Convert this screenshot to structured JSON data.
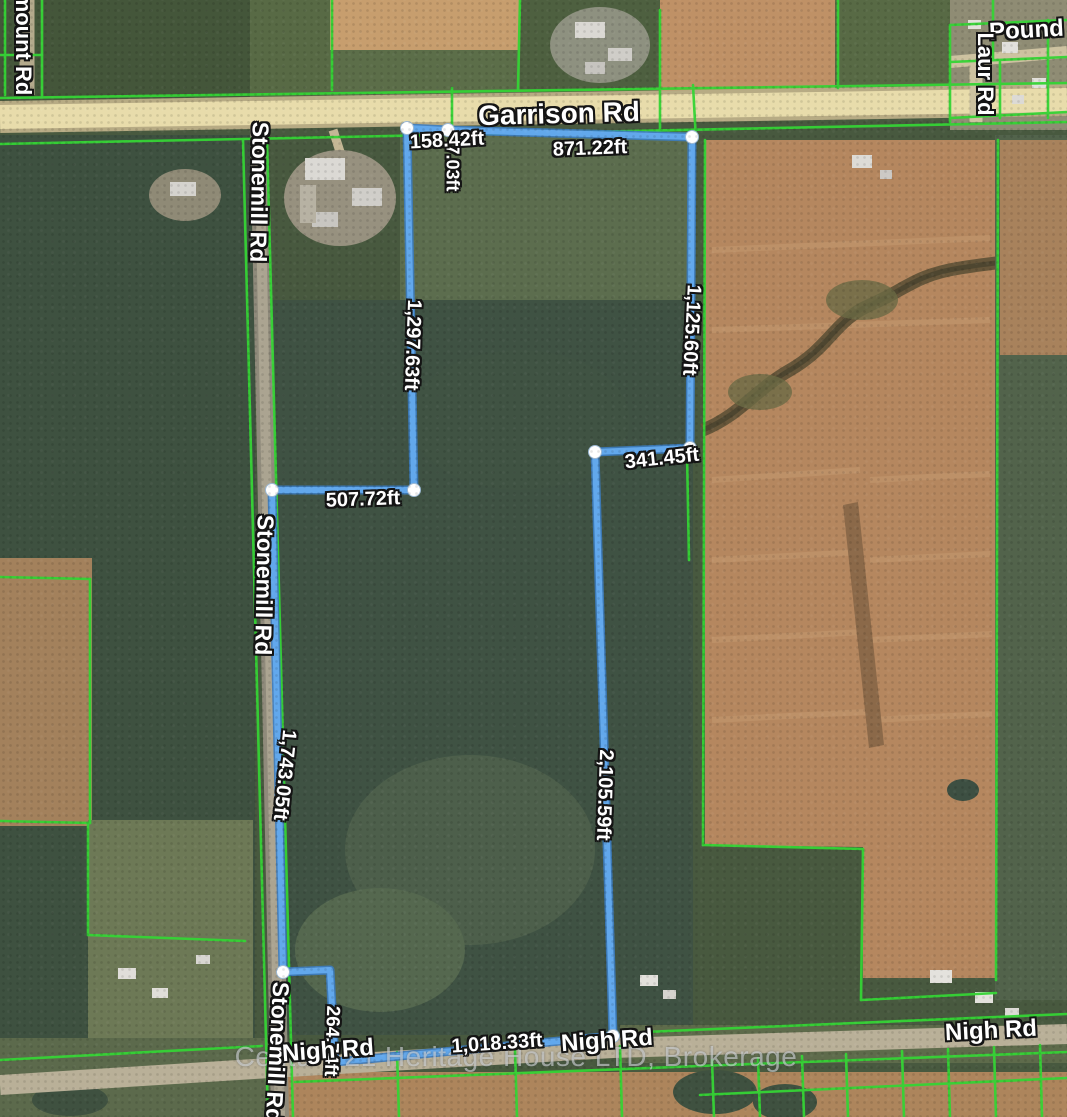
{
  "title": "Aerial parcel map with surveyed property boundary",
  "roads": {
    "garrison": "Garrison Rd",
    "stonemill": "Stonemill Rd",
    "nigh": "Nigh Rd",
    "laur": "Laur Rd",
    "pound": "Pound A",
    "mount": "mount Rd"
  },
  "measurements": {
    "garrison_frontage_west": "158.42ft",
    "garrison_frontage_east": "871.22ft",
    "north_jog": "7.03ft",
    "west_boundary_upper": "1,297.63ft",
    "east_boundary_upper": "1,125.60ft",
    "interior_west": "507.72ft",
    "interior_east": "341.45ft",
    "west_boundary_lower": "1,743.05ft",
    "east_boundary_lower": "2,105.59ft",
    "south_jog": "264.74ft",
    "south_boundary": "1,018.33ft"
  },
  "watermark": "Century 21 Heritage House LTD, Brokerage",
  "colors": {
    "boundary_line": "#62a8ec",
    "vertex_dot": "#ffffff",
    "parcel_lines": "#35d435",
    "road_fill": "#e8dcab"
  }
}
